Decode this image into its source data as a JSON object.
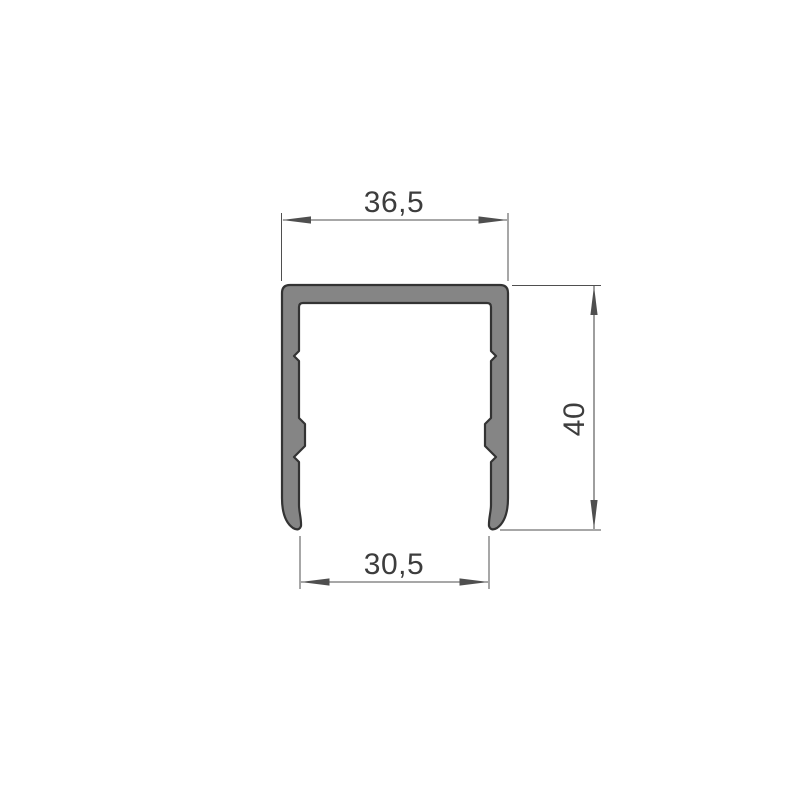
{
  "drawing": {
    "title": "c-channel-profile-cross-section",
    "dimensions": {
      "outer_width": {
        "label": "36,5",
        "value": 36.5
      },
      "height": {
        "label": "40",
        "value": 40
      },
      "opening_width": {
        "label": "30,5",
        "value": 30.5
      }
    },
    "colors": {
      "background": "#ffffff",
      "profile_fill": "#858585",
      "profile_stroke": "#333333",
      "dimension_line": "#4f4f4f",
      "text": "#3d3d3d"
    }
  }
}
